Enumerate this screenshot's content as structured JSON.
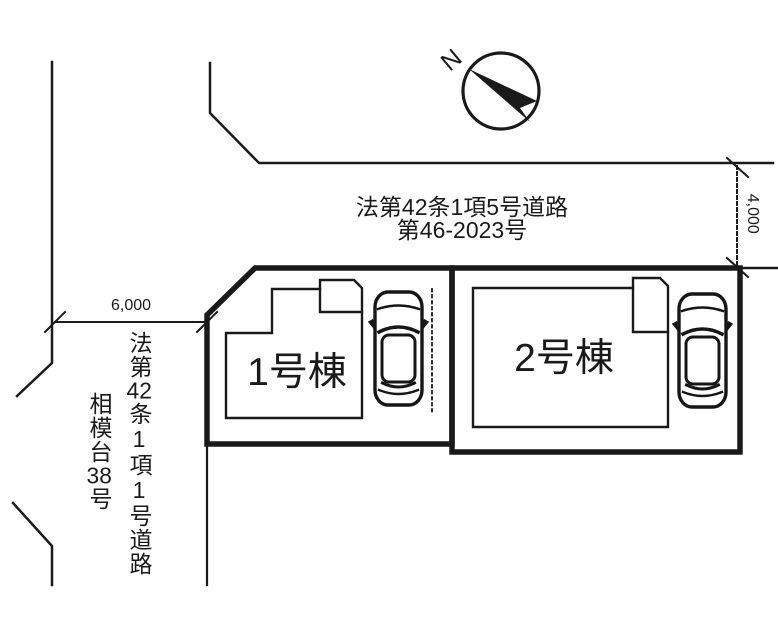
{
  "site_plan": {
    "compass": {
      "north_label": "N"
    },
    "north_road": {
      "name": "法第42条1項5号道路",
      "number": "第46-2023号",
      "width_label": "4,000"
    },
    "west_road": {
      "width_label": "6,000",
      "name_segments": [
        "法",
        "第",
        "42",
        "条",
        "1",
        "項",
        "1",
        "号",
        "道",
        "路"
      ],
      "id_segments": [
        "相",
        "模",
        "台",
        "38",
        "号"
      ]
    },
    "lots": {
      "lot1_label": "1号棟",
      "lot2_label": "2号棟"
    },
    "colors": {
      "ink": "#1a1a1a",
      "background": "#ffffff"
    }
  }
}
